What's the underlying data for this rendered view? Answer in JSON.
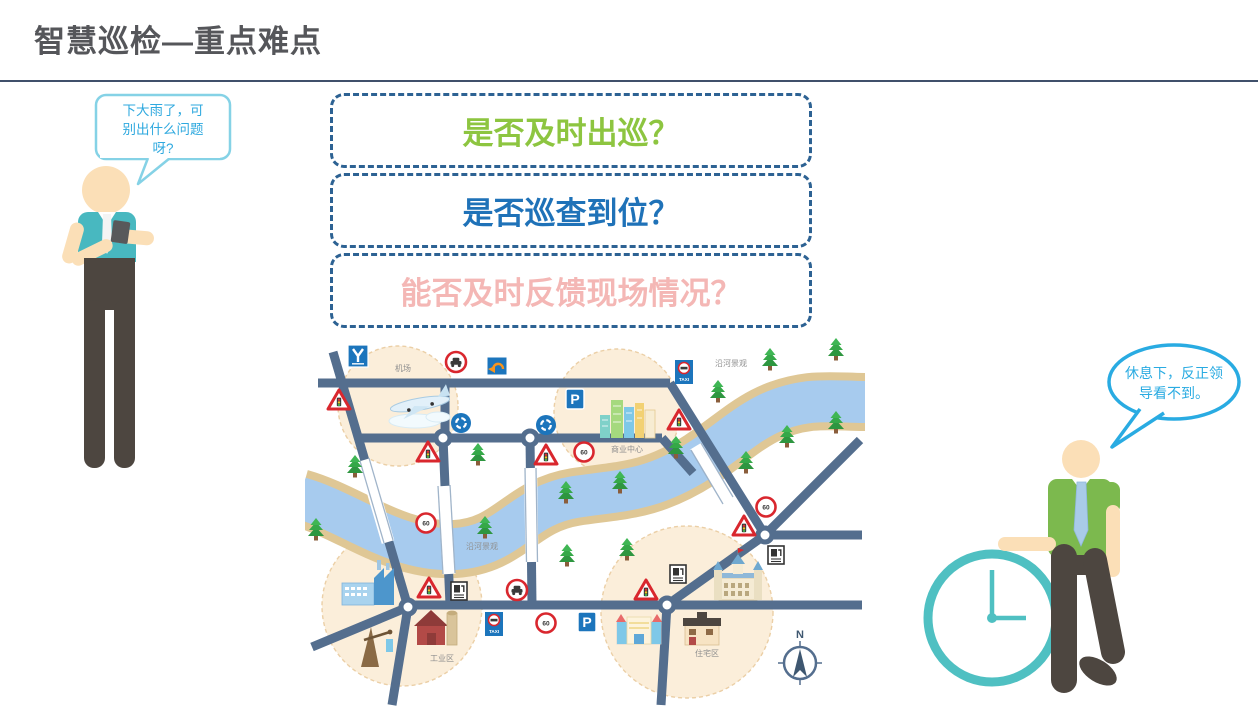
{
  "title": "智慧巡检—重点难点",
  "questions": [
    {
      "text": "是否及时出巡？",
      "color": "#8DC540"
    },
    {
      "text": "是否巡查到位？",
      "color": "#1F72B8"
    },
    {
      "text": "能否及时反馈现场情况？",
      "color": "#F4B7B5"
    }
  ],
  "left_person": {
    "speech_lines": [
      "下大雨了，可",
      "别出什么问题",
      "呀?"
    ]
  },
  "right_person": {
    "speech_lines": [
      "休息下，反正领",
      "导看不到。"
    ]
  },
  "map": {
    "labels": {
      "airport": "机场",
      "commercial": "商业中心",
      "riverside_upper": "沿河景观",
      "riverside_lower": "沿河景观",
      "industrial": "工业区",
      "residential": "住宅区"
    },
    "signs": {
      "speed_limit": "60",
      "parking": "P",
      "taxi": "TAXI"
    },
    "compass": "N"
  },
  "colors": {
    "title": "#55565A",
    "divider": "#40506B",
    "question_border": "#2D6293",
    "road": "#546E8E",
    "river": "#A7CBEE",
    "riverbank": "#DFC795",
    "zone_fill": "#FBEEDA",
    "left_shirt": "#48B8C0",
    "right_shirt": "#7CB94E",
    "clock": "#4FC0C2",
    "bubble_left_border": "#85D2E6",
    "bubble_right_border": "#29ABE2"
  }
}
